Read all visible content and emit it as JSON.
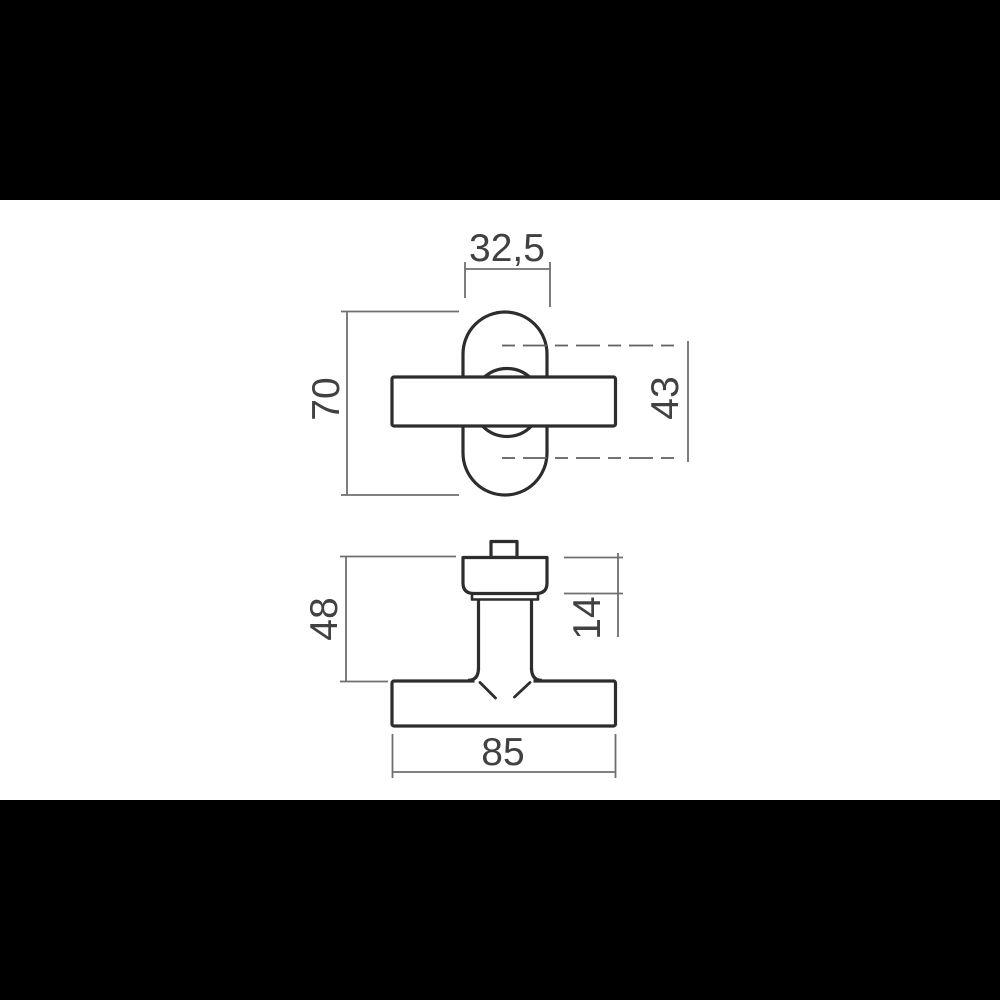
{
  "drawing": {
    "type": "technical-drawing",
    "views": {
      "front": {
        "dims": {
          "rosette_width": "32,5",
          "rosette_height": "70",
          "screw_centers": "43"
        }
      },
      "side": {
        "dims": {
          "height_to_grip": "48",
          "rosette_depth": "14",
          "grip_length": "85"
        }
      }
    },
    "colors": {
      "background": "#000000",
      "canvas": "#ffffff",
      "object_line": "#2d2d2d",
      "dimension_line": "#6f6f6f",
      "center_line": "#5f5f5f",
      "text_color": "#414141"
    }
  }
}
